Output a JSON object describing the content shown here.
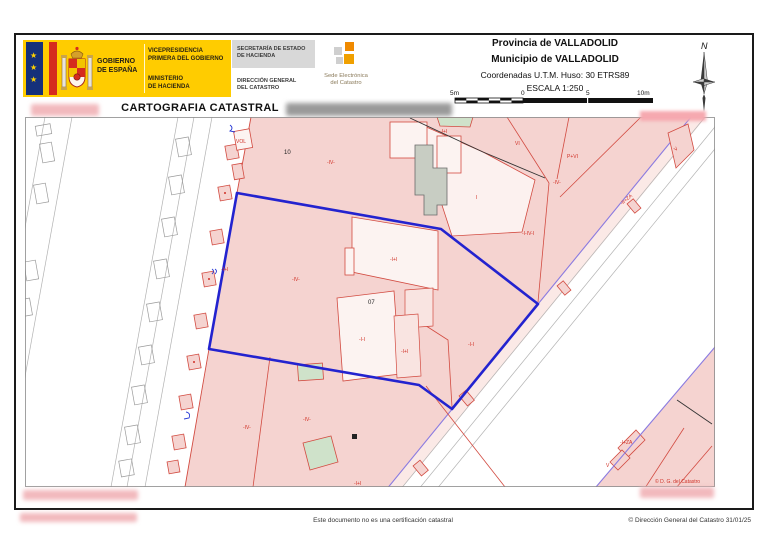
{
  "header": {
    "gobierno1": "GOBIERNO",
    "gobierno2": "DE ESPAÑA",
    "vice1": "VICEPRESIDENCIA",
    "vice2": "PRIMERA DEL GOBIERNO",
    "min1": "MINISTERIO",
    "min2": "DE HACIENDA",
    "sec1": "SECRETARÍA DE ESTADO",
    "sec2": "DE HACIENDA",
    "dg1": "DIRECCIÓN GENERAL",
    "dg2": "DEL CATASTRO",
    "sede1": "Sede Electrónica",
    "sede2": "del Catastro",
    "provincia": "Provincia de VALLADOLID",
    "municipio": "Municipio de VALLADOLID",
    "coordenadas": "Coordenadas U.T.M. Huso: 30 ETRS89",
    "escala": "ESCALA 1:250",
    "scale_labels": [
      "5m",
      "0",
      "5",
      "10m"
    ],
    "north": "N"
  },
  "title": "CARTOGRAFIA CATASTRAL",
  "map": {
    "parcel_number_10": "10",
    "parcel_number_07": "07",
    "copyright": "© D. G. del Catastro",
    "labels": [
      {
        "text": "-IV-"
      },
      {
        "text": "-I+I"
      },
      {
        "text": "VI"
      },
      {
        "text": "P+VI"
      },
      {
        "text": "-I-IV-I"
      },
      {
        "text": "I"
      },
      {
        "text": "-I+I"
      },
      {
        "text": "-I-I"
      },
      {
        "text": "-I+I"
      },
      {
        "text": "-IV-"
      },
      {
        "text": "-I+I"
      },
      {
        "text": "-IV-"
      },
      {
        "text": "-IV-"
      },
      {
        "text": "-I+I"
      },
      {
        "text": "-II+ZA"
      },
      {
        "text": "V"
      },
      {
        "text": "-I+ZA"
      },
      {
        "text": "V"
      },
      {
        "text": "VOL"
      },
      {
        "text": "-I-I"
      },
      {
        "text": "-IV-"
      }
    ]
  },
  "footer": {
    "disclaimer": "Este documento no es una certificación catastral",
    "copyright": "© Dirección General del Catastro 31/01/25"
  },
  "colors": {
    "brand_yellow": "#ffcc00",
    "flag_red": "#d52b1e",
    "flag_blue": "#15307a",
    "parcel_pink": "#f5d3d0",
    "parcel_light": "#fbe9e6",
    "building_white": "#fcf3f1",
    "cadastral_red": "#d24b41",
    "boundary_blue": "#2323cf",
    "street_purple": "#8a7ae0",
    "patio_green": "#cfe2ca",
    "courtyard_gray": "#c8cdc3",
    "sede_orange": "#f08a00"
  }
}
